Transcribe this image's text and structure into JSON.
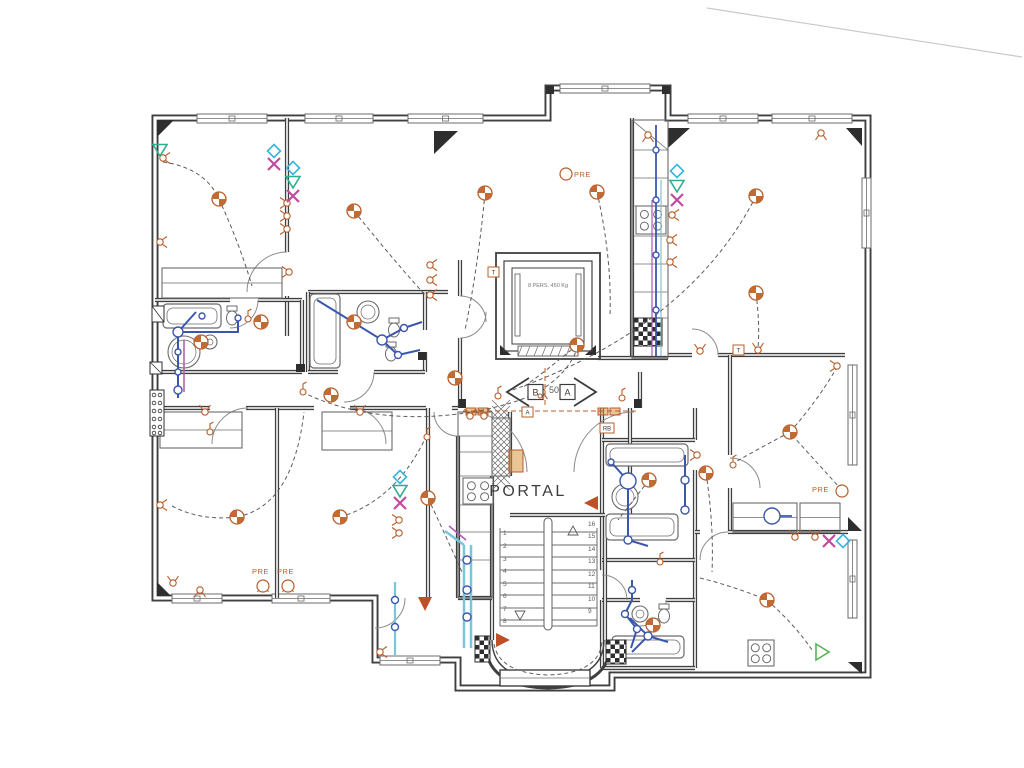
{
  "meta": {
    "kind": "scanned-electrical-floor-plan"
  },
  "colors": {
    "wall": "#3f3f3f",
    "wallFill": "#ffffff",
    "fixture": "#6b6b6b",
    "orange": "#b85c28",
    "orangeFill": "#c06a34",
    "orangeLight": "#d9953f",
    "redOrange": "#bf4f28",
    "blue": "#3b57ad",
    "cyanPipe": "#7cc4d8",
    "magentaPipe": "#b056ad",
    "diamond": "#35b6d9",
    "tealTri": "#2fae8f",
    "magentaX": "#c3499d",
    "greenTri": "#55b455",
    "text": "#3c3c3c",
    "num": "#5a5a5a",
    "wire": "#5c5c5c",
    "artifact": "#c9c9c9",
    "dark": "#2e2e2e"
  },
  "labels": {
    "portal": "PORTAL",
    "pre": "PRE",
    "elevator": "8 PERS. 450 Kg",
    "apt_a": "A",
    "apt_b": "B",
    "dim50": "50",
    "stairs_left": [
      "1",
      "2",
      "3",
      "4",
      "5",
      "6",
      "7",
      "8"
    ],
    "stairs_right": [
      "16",
      "15",
      "14",
      "13",
      "12",
      "11",
      "10",
      "9"
    ]
  },
  "tags": [
    {
      "t": "T",
      "x": 488,
      "y": 267,
      "w": 11
    },
    {
      "t": "T",
      "x": 733,
      "y": 345,
      "w": 11
    },
    {
      "t": "A",
      "x": 522,
      "y": 407,
      "w": 11
    },
    {
      "t": "RB",
      "x": 600,
      "y": 423,
      "w": 14
    }
  ],
  "portal_pos": {
    "x": 528,
    "y": 496,
    "fs": 16,
    "ls": 2.5
  },
  "elevator_label_pos": {
    "x": 548,
    "y": 287,
    "fs": 5.5
  },
  "dim50_pos": {
    "x": 549,
    "y": 393,
    "fs": 9
  },
  "arrows": {
    "a": {
      "cx": 583,
      "cy": 392
    },
    "b": {
      "cx": 520,
      "cy": 392
    }
  },
  "pre_items": [
    {
      "tx": 574,
      "ty": 177,
      "cx": 566,
      "cy": 174
    },
    {
      "tx": 812,
      "ty": 492,
      "cx": 842,
      "cy": 491
    },
    {
      "tx": 252,
      "ty": 574,
      "cx": 263,
      "cy": 586
    },
    {
      "tx": 277,
      "ty": 574,
      "cx": 288,
      "cy": 586
    }
  ],
  "walls": {
    "outer": "M155,118 L548,118 L548,88 L668,88 L668,118 L868,118 L868,675 L612,675 L612,688 L458,688 L458,660 L375,660 L375,598 L155,598 Z",
    "inner": [
      "M287,118 L287,252",
      "M287,296 L287,336",
      "M155,300 L230,300 M258,300 L302,300",
      "M302,300 L302,372",
      "M155,372 L302,372",
      "M155,408 L210,408 M246,408 L314,408 M350,408 L426,408 M452,408 L458,408",
      "M277,408 L277,598",
      "M428,408 L428,598",
      "M308,292 L448,292",
      "M308,292 L308,372",
      "M425,292 L425,330 M425,352 L425,372",
      "M308,372 L338,372 M374,372 L425,372",
      "M460,260 L460,296 M460,338 L460,408",
      "M632,118 L632,358",
      "M598,358 L668,358",
      "M668,355 L692,355 M718,355 L845,355",
      "M730,355 L730,455",
      "M730,488 L730,532",
      "M602,408 L602,570 M602,600 L602,668",
      "M695,408 L695,440 M695,470 L695,668",
      "M602,440 L695,440",
      "M602,560 L695,560",
      "M602,600 L640,600 M666,600 L695,600",
      "M602,668 L695,668",
      "M695,532 L700,532 M728,532 L848,532",
      "M458,436 L458,598",
      "M492,476 L492,640",
      "M510,412 L510,476",
      "M630,408 L630,515",
      "M605,515 L605,640",
      "M458,598 L492,598",
      "M640,372 L640,408",
      "M510,515 L605,515"
    ],
    "oval_outer": "M485,640 C485,672 506,687 548,688 C590,687 611,672 611,640",
    "oval_inner": "M492,640 C492,666 511,679 548,680 C585,679 604,666 604,640"
  },
  "windows": [
    [
      197,
      114,
      70,
      "h"
    ],
    [
      305,
      114,
      68,
      "h"
    ],
    [
      408,
      114,
      75,
      "h"
    ],
    [
      688,
      114,
      70,
      "h"
    ],
    [
      772,
      114,
      80,
      "h"
    ],
    [
      560,
      84,
      90,
      "h"
    ],
    [
      862,
      178,
      70,
      "v"
    ],
    [
      848,
      365,
      100,
      "v"
    ],
    [
      848,
      540,
      78,
      "v"
    ],
    [
      172,
      594,
      50,
      "h"
    ],
    [
      272,
      594,
      58,
      "h"
    ],
    [
      380,
      656,
      60,
      "h"
    ]
  ],
  "doors": [
    "M248,408 A36 36 0 0 0 212,444",
    "M350,408 A36 36 0 0 1 386,444",
    "M287,252 A40 40 0 0 0 247,292",
    "M460,296 A26 26 0 0 1 486,322",
    "M460,338 A26 26 0 0 0 486,312",
    "M467,412 A60 60 0 0 1 527,472",
    "M634,412 A60 60 0 0 0 574,472",
    "M718,355 A26 26 0 0 0 692,329",
    "M730,458 A30 30 0 0 1 760,488",
    "M700,560 A28 28 0 0 1 728,532",
    "M374,372 A30 30 0 0 1 344,402",
    "M258,300 A28 28 0 0 1 230,328",
    "M458,436 A24 24 0 0 1 434,412",
    "M405,598 A30 30 0 0 1 375,628",
    "M602,575 A25 25 0 0 1 627,600",
    "M666,600 A26 26 0 0 1 640,626"
  ],
  "wedges": [
    [
      [
        157,
        120
      ],
      [
        174,
        120
      ],
      [
        157,
        137
      ]
    ],
    [
      [
        434,
        131
      ],
      [
        458,
        131
      ],
      [
        434,
        154
      ]
    ],
    [
      [
        668,
        128
      ],
      [
        690,
        128
      ],
      [
        668,
        148
      ]
    ],
    [
      [
        846,
        128
      ],
      [
        862,
        128
      ],
      [
        862,
        146
      ]
    ],
    [
      [
        848,
        517
      ],
      [
        862,
        531
      ],
      [
        848,
        531
      ]
    ],
    [
      [
        848,
        662
      ],
      [
        862,
        662
      ],
      [
        862,
        674
      ]
    ],
    [
      [
        157,
        582
      ],
      [
        171,
        596
      ],
      [
        157,
        596
      ]
    ],
    [
      [
        500,
        345
      ],
      [
        511,
        355
      ],
      [
        500,
        355
      ]
    ],
    [
      [
        596,
        345
      ],
      [
        585,
        355
      ],
      [
        596,
        355
      ]
    ]
  ],
  "jambs": [
    [
      459,
      399,
      7,
      9
    ],
    [
      634,
      399,
      7,
      9
    ],
    [
      296,
      364,
      9,
      8
    ],
    [
      418,
      352,
      8,
      8
    ],
    [
      546,
      86,
      8,
      8
    ],
    [
      662,
      86,
      8,
      8
    ]
  ],
  "closets": [
    [
      162,
      268,
      120,
      30
    ],
    [
      160,
      412,
      82,
      36
    ],
    [
      322,
      412,
      70,
      38
    ],
    [
      733,
      503,
      64,
      29
    ],
    [
      800,
      503,
      40,
      29
    ]
  ],
  "tubs": [
    [
      163,
      304,
      58,
      24
    ],
    [
      606,
      444,
      82,
      22
    ],
    [
      606,
      514,
      72,
      26
    ],
    [
      612,
      636,
      72,
      22
    ],
    [
      310,
      294,
      30,
      74
    ]
  ],
  "sinks": [
    [
      368,
      312,
      11
    ],
    [
      625,
      497,
      13
    ],
    [
      640,
      614,
      8
    ],
    [
      210,
      342,
      7
    ],
    [
      184,
      352,
      16
    ]
  ],
  "toilets": [
    [
      232,
      316
    ],
    [
      394,
      328
    ],
    [
      391,
      352
    ],
    [
      664,
      614
    ]
  ],
  "stoves": [
    [
      463,
      478,
      30,
      26
    ],
    [
      636,
      206,
      30,
      28
    ],
    [
      748,
      640,
      26,
      26
    ]
  ],
  "checkers": [
    [
      634,
      318,
      28,
      28
    ],
    [
      606,
      640,
      20,
      24
    ],
    [
      475,
      636,
      15,
      26
    ]
  ],
  "hatches": [
    [
      492,
      418,
      18,
      58
    ]
  ],
  "counters": [
    {
      "rect": [
        632,
        120,
        36,
        238
      ],
      "divs": [
        150,
        178,
        206,
        236,
        264,
        292,
        318
      ],
      "diag": true
    },
    {
      "rect": [
        458,
        412,
        34,
        186
      ],
      "divs": [
        436,
        452,
        476,
        505,
        532,
        560
      ],
      "diag": false
    }
  ],
  "meter_panel": {
    "rect": [
      150,
      390,
      14,
      46
    ],
    "cols": [
      154,
      160
    ],
    "rows": [
      395,
      403,
      411,
      419,
      427,
      433
    ]
  },
  "small_boxes": [
    [
      152,
      306,
      12,
      16
    ],
    [
      150,
      362,
      12,
      12
    ]
  ],
  "orange_panels": [
    [
      509,
      450,
      14,
      22
    ],
    [
      466,
      408,
      10,
      7
    ],
    [
      478,
      408,
      10,
      7
    ],
    [
      598,
      408,
      10,
      7
    ],
    [
      610,
      408,
      10,
      7
    ]
  ],
  "elevator": {
    "outer": [
      496,
      253,
      104,
      106
    ],
    "mid": [
      504,
      261,
      88,
      90
    ],
    "cab": [
      512,
      268,
      72,
      76
    ],
    "rails": [
      [
        515,
        274,
        5,
        62
      ],
      [
        576,
        274,
        5,
        62
      ]
    ],
    "door": [
      518,
      346,
      60,
      10
    ]
  },
  "stairs": {
    "left_x": 500,
    "right_x": 597,
    "top_y": 528,
    "bottom_y": 626,
    "step_ys": [
      532,
      545,
      557,
      570,
      583,
      595,
      608,
      620
    ],
    "rail": [
      544,
      518,
      8,
      112
    ],
    "num_left_x": 503,
    "num_right_x": 588,
    "left_ys": [
      535,
      548,
      561,
      573,
      586,
      598,
      611,
      623
    ],
    "right_ys": [
      526,
      538,
      551,
      563,
      576,
      588,
      601,
      613
    ],
    "tri_up": [
      573,
      531
    ],
    "tri_down": [
      520,
      615
    ],
    "landing": [
      500,
      670,
      90,
      16
    ]
  },
  "lights": [
    [
      219,
      199
    ],
    [
      354,
      211
    ],
    [
      485,
      193
    ],
    [
      597,
      192
    ],
    [
      756,
      196
    ],
    [
      756,
      293
    ],
    [
      577,
      345
    ],
    [
      201,
      342
    ],
    [
      261,
      322
    ],
    [
      354,
      322
    ],
    [
      455,
      378
    ],
    [
      331,
      395
    ],
    [
      237,
      517
    ],
    [
      340,
      517
    ],
    [
      428,
      498
    ],
    [
      649,
      480
    ],
    [
      653,
      625
    ],
    [
      706,
      473
    ],
    [
      790,
      432
    ],
    [
      767,
      600
    ]
  ],
  "sockets": [
    [
      163,
      158,
      90
    ],
    [
      160,
      242,
      90
    ],
    [
      160,
      505,
      90
    ],
    [
      173,
      583,
      0
    ],
    [
      287,
      203,
      270
    ],
    [
      287,
      216,
      270
    ],
    [
      287,
      229,
      270
    ],
    [
      289,
      272,
      270
    ],
    [
      430,
      265,
      90
    ],
    [
      430,
      280,
      90
    ],
    [
      430,
      295,
      90
    ],
    [
      672,
      215,
      90
    ],
    [
      670,
      240,
      90
    ],
    [
      670,
      262,
      90
    ],
    [
      700,
      351,
      0
    ],
    [
      758,
      350,
      0
    ],
    [
      821,
      133,
      180
    ],
    [
      837,
      366,
      270
    ],
    [
      795,
      537,
      0
    ],
    [
      815,
      537,
      0
    ],
    [
      205,
      412,
      0
    ],
    [
      360,
      412,
      0
    ],
    [
      200,
      590,
      180
    ],
    [
      263,
      585,
      180
    ],
    [
      288,
      585,
      180
    ],
    [
      380,
      652,
      90
    ],
    [
      470,
      416,
      0
    ],
    [
      484,
      416,
      0
    ],
    [
      542,
      392,
      180
    ],
    [
      697,
      455,
      270
    ],
    [
      648,
      135,
      180
    ],
    [
      399,
      520,
      270
    ],
    [
      399,
      533,
      270
    ]
  ],
  "switches": [
    [
      248,
      319
    ],
    [
      303,
      392
    ],
    [
      498,
      396
    ],
    [
      622,
      398
    ],
    [
      733,
      465
    ],
    [
      660,
      562
    ],
    [
      427,
      437
    ],
    [
      210,
      432
    ]
  ],
  "accents": {
    "diamonds": [
      [
        274,
        151
      ],
      [
        293,
        168
      ],
      [
        677,
        171
      ],
      [
        400,
        477
      ],
      [
        843,
        541
      ]
    ],
    "tris_down": [
      [
        160,
        149
      ],
      [
        293,
        181
      ],
      [
        677,
        185
      ],
      [
        400,
        490
      ]
    ],
    "xs": [
      [
        274,
        164
      ],
      [
        293,
        196
      ],
      [
        677,
        200
      ],
      [
        400,
        503
      ],
      [
        829,
        541
      ]
    ],
    "tris_green": [
      [
        820,
        652
      ]
    ],
    "tris_filled": [
      [
        592,
        503,
        180
      ],
      [
        502,
        640,
        0
      ],
      [
        425,
        603,
        90
      ]
    ]
  },
  "wiring": [
    "M163,162 Q205,168 219,199 Q240,245 252,286",
    "M354,211 Q400,268 428,298",
    "M485,193 Q478,268 465,330",
    "M597,192 Q612,258 610,316",
    "M756,196 Q688,330 504,393",
    "M756,293 Q760,325 758,347",
    "M302,392 C380,430 470,417 520,400 C552,388 570,368 577,349",
    "M237,517 Q293,506 304,412",
    "M172,506 Q200,521 237,517",
    "M340,517 Q394,501 424,441",
    "M790,432 Q818,400 836,369",
    "M790,432 Q762,447 737,461",
    "M792,435 Q820,466 840,488",
    "M706,473 Q714,525 712,572",
    "M700,578 Q733,586 767,600",
    "M767,600 Q796,626 812,650",
    "M577,345 Q545,372 522,388",
    "M428,498 Q450,545 462,572",
    "M649,480 Q632,502 618,520",
    "M494,644 C498,666 520,674 548,675 C580,674 600,664 602,642"
  ],
  "dashed_orange": [
    "M463,411 L638,411",
    "M545,368 L545,408"
  ],
  "pipes": [
    {
      "d": "M196,312 L178,332 L178,398",
      "c": "blue",
      "w": 2
    },
    {
      "d": "M178,332 L238,332 L238,318",
      "c": "blue",
      "w": 2
    },
    {
      "d": "M184,340 L184,392",
      "c": "magentaPipe",
      "w": 1.5
    },
    {
      "d": "M317,300 L382,340 L398,355 L420,350",
      "c": "blue",
      "w": 2
    },
    {
      "d": "M382,340 L404,328 L422,322",
      "c": "blue",
      "w": 2
    },
    {
      "d": "M611,462 L628,481 L628,540 L648,546",
      "c": "blue",
      "w": 2
    },
    {
      "d": "M685,455 L685,512",
      "c": "blue",
      "w": 2
    },
    {
      "d": "M630,618 L648,636 L632,652",
      "c": "blue",
      "w": 2
    },
    {
      "d": "M648,636 L668,642",
      "c": "blue",
      "w": 2
    },
    {
      "d": "M656,125 L656,356",
      "c": "blue",
      "w": 1.8
    },
    {
      "d": "M652,200 L652,356",
      "c": "magentaPipe",
      "w": 1.2
    },
    {
      "d": "M661,180 L661,356",
      "c": "cyanPipe",
      "w": 1.2
    },
    {
      "d": "M464,545 L464,648",
      "c": "cyanPipe",
      "w": 2.5
    },
    {
      "d": "M471,545 L471,648",
      "c": "cyanPipe",
      "w": 2.5
    },
    {
      "d": "M464,545 L445,531",
      "c": "cyanPipe",
      "w": 2.5
    },
    {
      "d": "M449,526 L466,540",
      "c": "magentaPipe",
      "w": 1.5
    },
    {
      "d": "M395,582 L395,655",
      "c": "cyanPipe",
      "w": 2.2
    },
    {
      "d": "M632,580 L632,600 L625,614 L637,629 L631,648",
      "c": "blue",
      "w": 2
    },
    {
      "d": "M772,516 L792,516",
      "c": "blue",
      "w": 1.8
    }
  ],
  "pipe_nodes": [
    [
      178,
      332,
      5
    ],
    [
      178,
      352,
      3
    ],
    [
      178,
      372,
      3
    ],
    [
      178,
      390,
      4
    ],
    [
      238,
      318,
      3
    ],
    [
      382,
      340,
      5
    ],
    [
      404,
      328,
      3.5
    ],
    [
      398,
      355,
      3.5
    ],
    [
      628,
      481,
      8
    ],
    [
      628,
      540,
      4
    ],
    [
      611,
      462,
      3
    ],
    [
      685,
      480,
      4
    ],
    [
      685,
      510,
      4
    ],
    [
      648,
      636,
      4
    ],
    [
      656,
      150,
      3
    ],
    [
      656,
      200,
      3
    ],
    [
      656,
      255,
      3
    ],
    [
      656,
      310,
      3
    ],
    [
      467,
      560,
      4
    ],
    [
      467,
      590,
      4
    ],
    [
      467,
      617,
      4
    ],
    [
      395,
      600,
      3.5
    ],
    [
      395,
      627,
      3.5
    ],
    [
      632,
      590,
      3.5
    ],
    [
      625,
      614,
      3.5
    ],
    [
      637,
      629,
      3.5
    ],
    [
      772,
      516,
      8
    ],
    [
      202,
      316,
      3
    ]
  ],
  "artifact": "M707,8 L1022,57"
}
